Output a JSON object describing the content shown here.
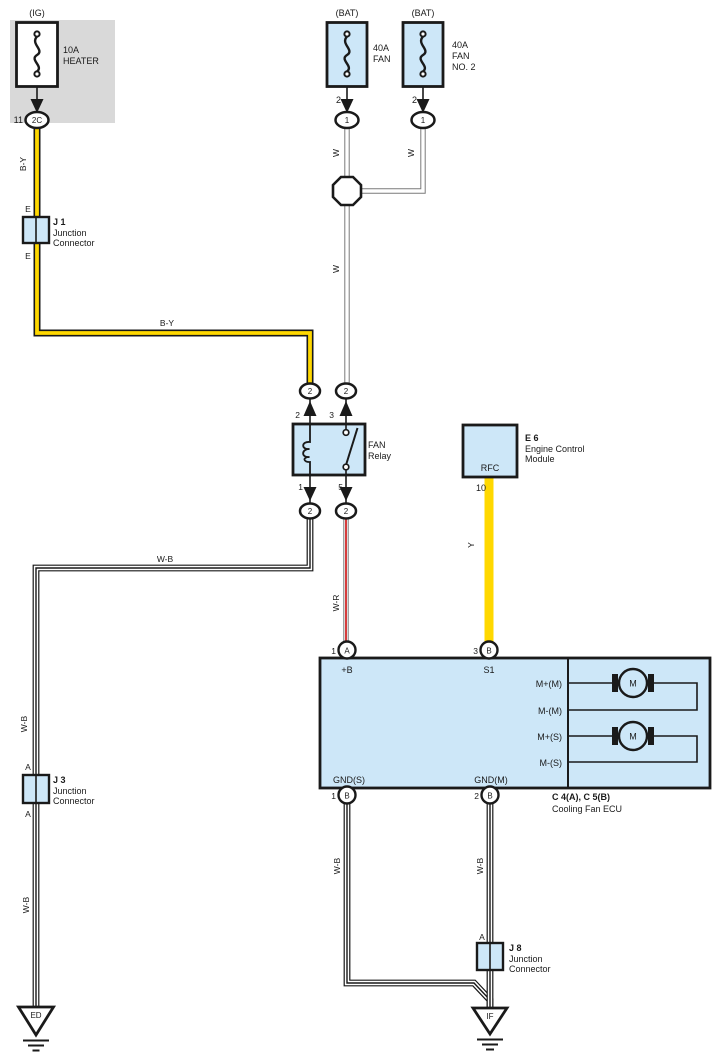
{
  "colors": {
    "component_fill": "#cde7f8",
    "block_gray": "#d9d9d9",
    "wire_yellow": "#ffd800",
    "wire_red": "#cf1a1a",
    "wire_white_outline": "#7a7a7a",
    "line_black": "#1a1a1a"
  },
  "fuses": {
    "ig": {
      "source": "(IG)",
      "rating": "10A",
      "name": "HEATER",
      "terminal": "11",
      "connector": "2C"
    },
    "fan": {
      "source": "(BAT)",
      "rating": "40A",
      "name": "FAN",
      "pin": "2",
      "connector": "1"
    },
    "fan2": {
      "source": "(BAT)",
      "rating": "40A",
      "name": "FAN",
      "name2": "NO. 2",
      "pin": "2",
      "connector": "1"
    }
  },
  "junctions": {
    "j1": {
      "id": "J 1",
      "desc1": "Junction",
      "desc2": "Connector",
      "pin_top": "E",
      "pin_bottom": "E"
    },
    "j3": {
      "id": "J 3",
      "desc1": "Junction",
      "desc2": "Connector",
      "pin_top": "A",
      "pin_bottom": "A"
    },
    "j8": {
      "id": "J 8",
      "desc1": "Junction",
      "desc2": "Connector",
      "pin_top": "A"
    }
  },
  "relay": {
    "name1": "FAN",
    "name2": "Relay",
    "pin_top_left": "2",
    "pin_top_right": "3",
    "pin_bottom_left": "1",
    "pin_bottom_right": "5",
    "conn_top_left": "2",
    "conn_top_right": "2",
    "conn_bottom_left": "2",
    "conn_bottom_right": "2"
  },
  "ecm": {
    "id": "E 6",
    "desc1": "Engine Control",
    "desc2": "Module",
    "terminal": "RFC",
    "pin": "10"
  },
  "ecu": {
    "id": "C 4(A), C 5(B)",
    "name": "Cooling Fan ECU",
    "pin1_num": "1",
    "pin1_conn": "A",
    "pin1_label": "+B",
    "pin3_num": "3",
    "pin3_conn": "B",
    "pin3_label": "S1",
    "gnd_s_num": "1",
    "gnd_s_conn": "B",
    "gnd_s_label": "GND(S)",
    "gnd_m_num": "2",
    "gnd_m_conn": "B",
    "gnd_m_label": "GND(M)",
    "m_plus_main": "M+(M)",
    "m_minus_main": "M-(M)",
    "m_plus_sub": "M+(S)",
    "m_minus_sub": "M-(S)",
    "motor1": "M",
    "motor2": "M"
  },
  "grounds": {
    "left": "ED",
    "right": "IF"
  },
  "wires": {
    "by_vertical": "B-Y",
    "by_horizontal": "B-Y",
    "w_fan": "W",
    "w_fan2": "W",
    "w_main": "W",
    "wb_horizontal": "W-B",
    "wb_left_upper": "W-B",
    "wb_left_lower": "W-B",
    "wr": "W-R",
    "y": "Y",
    "wb_gnd_s": "W-B",
    "wb_gnd_m": "W-B"
  }
}
